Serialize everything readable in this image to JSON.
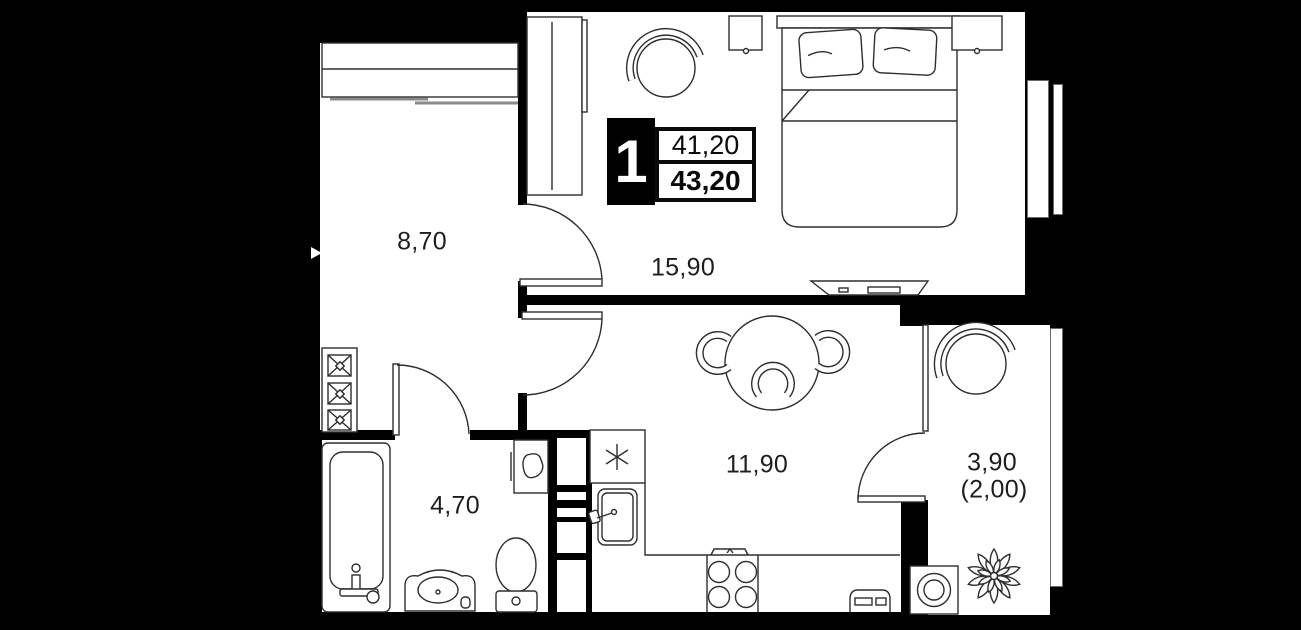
{
  "floor_plan": {
    "unit_badge": {
      "rooms_count": "1",
      "upper_area": "41,20",
      "total_area": "43,20"
    },
    "rooms": {
      "hallway": {
        "area": "8,70"
      },
      "bedroom": {
        "area": "15,90"
      },
      "kitchen_living": {
        "area": "11,90"
      },
      "bathroom": {
        "area": "4,70"
      },
      "balcony": {
        "area": "3,90",
        "area_with_factor": "(2,00)"
      }
    },
    "colors": {
      "background": "#000000",
      "floor": "#ffffff",
      "walls": "#000000",
      "furniture_line": "#2e2e2e"
    }
  }
}
